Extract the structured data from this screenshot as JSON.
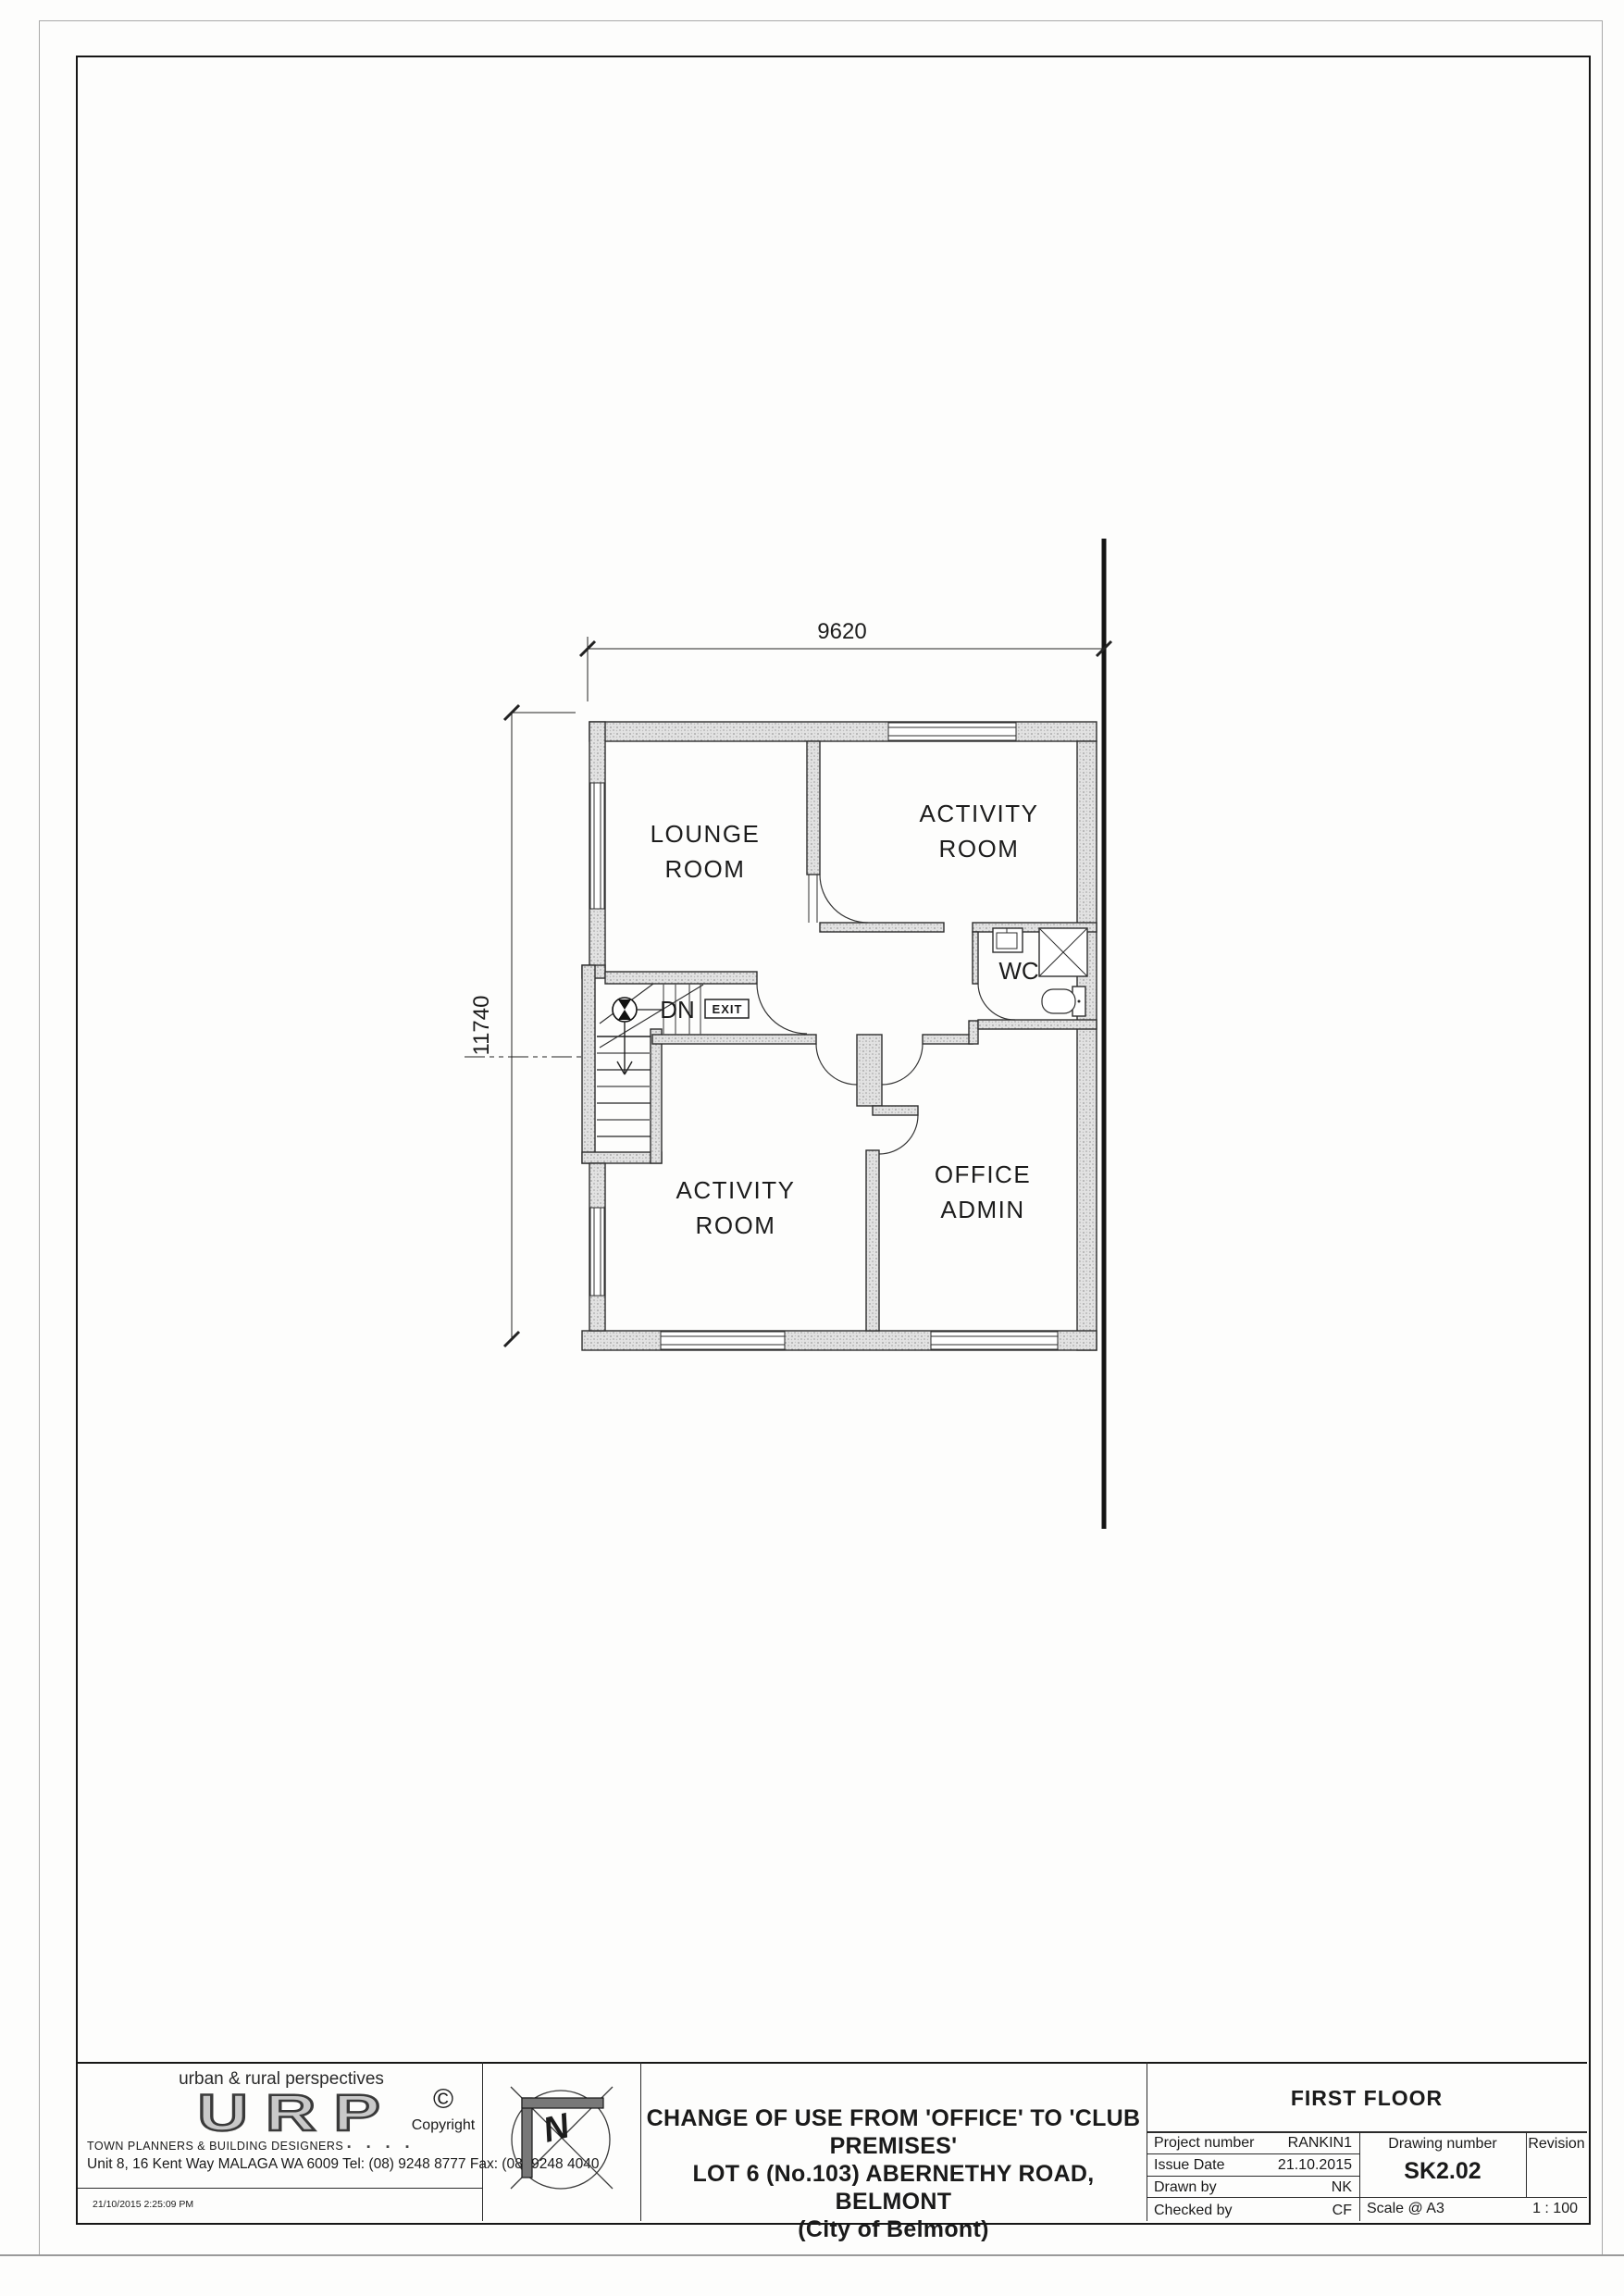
{
  "plan": {
    "dim_width": "9620",
    "dim_height": "11740",
    "lounge1": "LOUNGE",
    "lounge2": "ROOM",
    "activity_top1": "ACTIVITY",
    "activity_top2": "ROOM",
    "activity_bottom1": "ACTIVITY",
    "activity_bottom2": "ROOM",
    "office1": "OFFICE",
    "office2": "ADMIN",
    "wc": "WC",
    "dn": "DN",
    "exit": "EXIT"
  },
  "title_block": {
    "brand": {
      "tagline": "urban & rural perspectives",
      "logo": "URP",
      "subtitle": "TOWN PLANNERS & BUILDING DESIGNERS",
      "squares": "▪ ▪ ▪ ▪",
      "address": "Unit 8, 16 Kent Way MALAGA WA 6009 Tel: (08) 9248 8777 Fax: (08) 9248 4040",
      "timestamp": "21/10/2015 2:25:09 PM",
      "copyright_symbol": "©",
      "copyright_text": "Copyright"
    },
    "north_letter": "N",
    "project_title_lines": [
      "CHANGE OF USE FROM 'OFFICE' TO 'CLUB PREMISES'",
      "LOT 6 (No.103) ABERNETHY ROAD, BELMONT",
      "(City of Belmont)"
    ],
    "drawing_title": "FIRST FLOOR",
    "fields": {
      "project_number_label": "Project number",
      "project_number": "RANKIN1",
      "issue_date_label": "Issue Date",
      "issue_date": "21.10.2015",
      "drawn_by_label": "Drawn by",
      "drawn_by": "NK",
      "checked_by_label": "Checked by",
      "checked_by": "CF",
      "drawing_number_label": "Drawing number",
      "drawing_number": "SK2.02",
      "revision_label": "Revision",
      "scale_label": "Scale @ A3",
      "scale_value": "1 : 100"
    }
  }
}
